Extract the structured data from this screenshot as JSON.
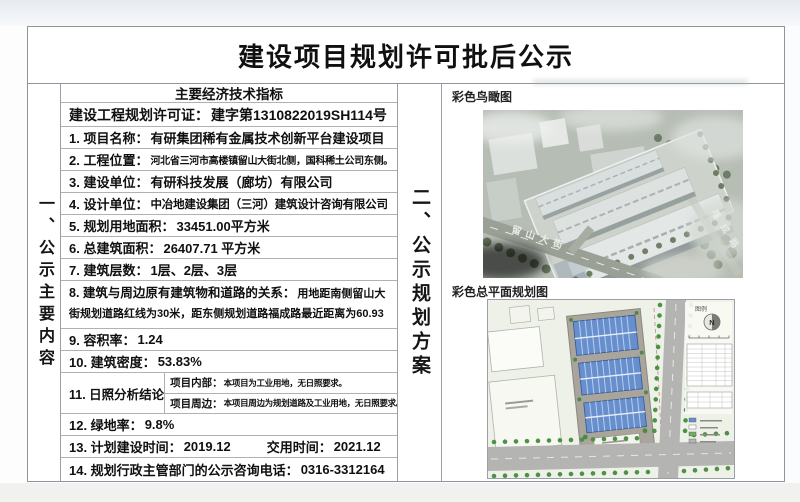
{
  "page": {
    "title": "建设项目规划许可批后公示"
  },
  "sections": {
    "left_label": "一、公示主要内容",
    "right_label": "二、公示规划方案"
  },
  "table": {
    "header": "主要经济技术指标",
    "rows": [
      {
        "label": "建设工程规划许可证：",
        "value": "建字第1310822019SH114号"
      },
      {
        "label": "1. 项目名称：",
        "value": "有研集团稀有金属技术创新平台建设项目"
      },
      {
        "label": "2. 工程位置：",
        "value": "河北省三河市高楼镇留山大街北侧，国科稀土公司东侧。"
      },
      {
        "label": "3. 建设单位：",
        "value": "有研科技发展（廊坊）有限公司"
      },
      {
        "label": "4. 设计单位：",
        "value": "中冶地建设集团（三河）建筑设计咨询有限公司"
      },
      {
        "label": "5. 规划用地面积：",
        "value": "33451.00平方米"
      },
      {
        "label": "6. 总建筑面积：",
        "value": "26407.71 平方米"
      },
      {
        "label": "7. 建筑层数：",
        "value": "1层、2层、3层"
      },
      {
        "label": "8. 建筑与周边原有建筑物和道路的关系：",
        "value": "用地距南侧留山大街规划道路红线为30米，距东侧规划道路福成路最近距离为60.93米。"
      },
      {
        "label": "9. 容积率：",
        "value": "1.24"
      },
      {
        "label": "10. 建筑密度：",
        "value": "53.83%"
      },
      {
        "label": "11. 日照分析结论",
        "sub": [
          {
            "k": "项目内部：",
            "v": "本项目为工业用地，无日照要求。"
          },
          {
            "k": "项目周边：",
            "v": "本项目周边为规划道路及工业用地，无日照要求。"
          }
        ]
      },
      {
        "label": "12. 绿地率：",
        "value": "9.8%"
      },
      {
        "label": "13. 计划建设时间：",
        "value": "2019.12",
        "label2": "交用时间：",
        "value2": "2021.12"
      },
      {
        "label": "14. 规划行政主管部门的公示咨询电话：",
        "value": "0316-3312164"
      }
    ]
  },
  "figures": {
    "aerial": {
      "label": "彩色鸟瞰图",
      "street_name": "留山大街",
      "road_name": "福成路"
    },
    "siteplan": {
      "label": "彩色总平面规划图",
      "legend_title": "图例",
      "north_letter": "N"
    }
  },
  "colors": {
    "border": "#8e959c",
    "aerial_ground": "#b6bdb4",
    "siteplan_bg": "#edf1e7",
    "building_roof_blue": "#678fcd",
    "tree_green": "#4d9145"
  }
}
